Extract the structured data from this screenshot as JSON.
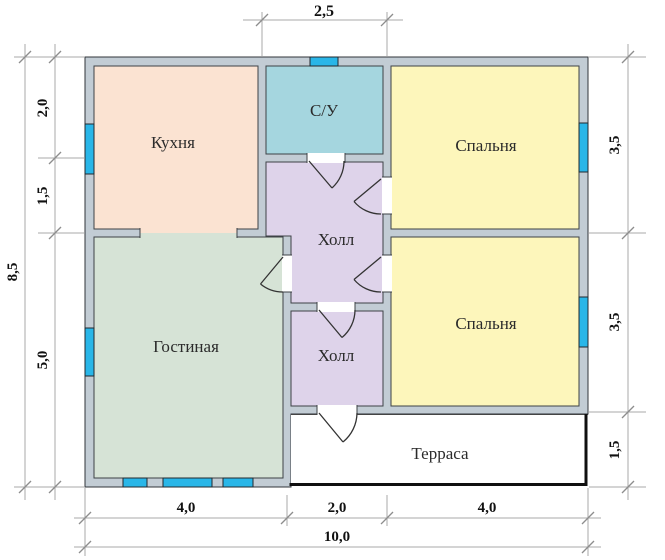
{
  "plan": {
    "title": "floor-plan",
    "colors": {
      "wall": "#c2ccd4",
      "kitchen": "#fbe3d2",
      "bathroom": "#a5d6df",
      "bedroom": "#fdf6bb",
      "hall": "#ded3ea",
      "living": "#d6e3d6",
      "terrace": "#ffffff",
      "window": "#29b6e8"
    },
    "rooms": {
      "kitchen": "Кухня",
      "bathroom": "С/У",
      "bedroom_top": "Спальня",
      "hall_upper": "Холл",
      "living": "Гостиная",
      "bedroom_bottom": "Спальня",
      "hall_lower": "Холл",
      "terrace": "Терраса"
    },
    "dimensions": {
      "top_width": "2,5",
      "left_total": "8,5",
      "left_segments": [
        "2,0",
        "1,5",
        "5,0"
      ],
      "right_segments": [
        "3,5",
        "3,5",
        "1,5"
      ],
      "bottom_segments": [
        "4,0",
        "2,0",
        "4,0"
      ],
      "bottom_total": "10,0"
    }
  }
}
